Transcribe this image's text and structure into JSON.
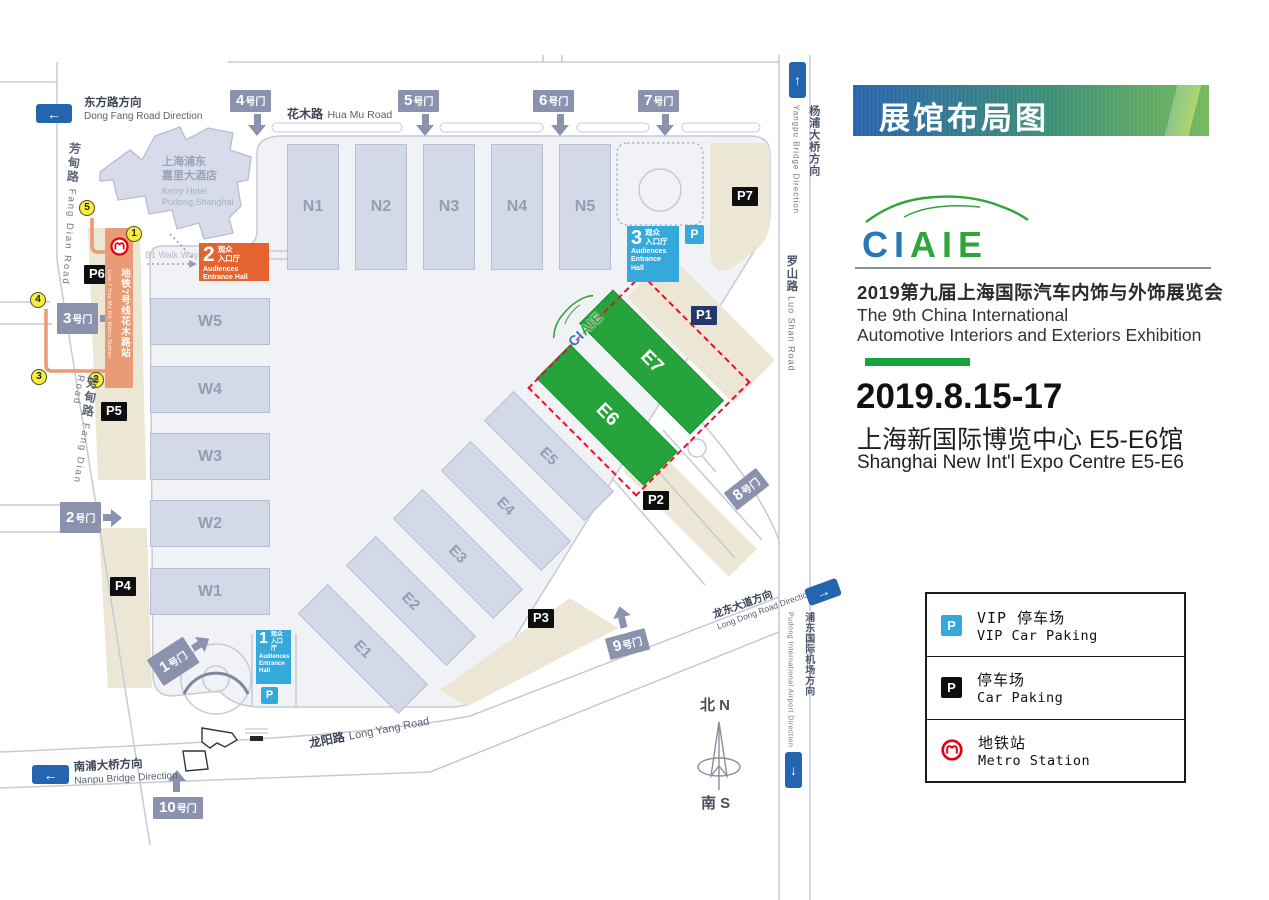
{
  "map": {
    "roads": {
      "dongfang": {
        "cn": "东方路方向",
        "en": "Dong Fang Road Direction"
      },
      "huamu": {
        "cn": "花木路",
        "en": "Hua Mu Road"
      },
      "fangdian": {
        "cn": "芳甸路",
        "en": "Fang Dian Road"
      },
      "yangpu": {
        "cn": "杨浦大桥方向",
        "en": "Yangpu Bridge Direction"
      },
      "luoshan": {
        "cn": "罗山路",
        "en": "Luo Shan Road"
      },
      "longyang": {
        "cn": "龙阳路",
        "en": "Long Yang Road"
      },
      "nanpu": {
        "cn": "南浦大桥方向",
        "en": "Nanpu Bridge Direction"
      },
      "longdong": {
        "cn": "龙东大道方向",
        "en": "Long Dong Road Direction"
      },
      "airport": {
        "cn": "浦东国际机场方向",
        "en": "Pudong International Airport Direction"
      }
    },
    "hotel": {
      "cn1": "上海浦东",
      "cn2": "嘉里大酒店",
      "en1": "Kerry Hotel",
      "en2": "Pudong,Shanghai"
    },
    "walkway": "B1 Walk Way",
    "metro_line": {
      "cn": "地铁7号线花木路站",
      "en": "Line 7 Hua Mu Rd. Metro Station"
    },
    "halls": {
      "n": [
        "N1",
        "N2",
        "N3",
        "N4",
        "N5"
      ],
      "w": [
        "W5",
        "W4",
        "W3",
        "W2",
        "W1"
      ],
      "e": [
        "E1",
        "E2",
        "E3",
        "E4",
        "E5"
      ],
      "green": [
        "E6",
        "E7"
      ]
    },
    "parkings": [
      "P1",
      "P2",
      "P3",
      "P4",
      "P5",
      "P6",
      "P7"
    ],
    "gates": [
      "1",
      "2",
      "3",
      "4",
      "5",
      "6",
      "7",
      "8",
      "9",
      "10"
    ],
    "gate_suffix": "号门",
    "ent": {
      "cn1": "观众",
      "cn2": "入口厅",
      "en": "Audiences Entrance Hall"
    },
    "entrances": {
      "one": "1",
      "two": "2",
      "three": "3"
    },
    "circled": [
      "1",
      "2",
      "3",
      "4",
      "5"
    ],
    "p_letter": "P",
    "compass": {
      "north": "北 N",
      "south": "南 S"
    }
  },
  "panel": {
    "banner": "展馆布局图",
    "logo_ci": "CI",
    "logo_aie": "AIE",
    "title_cn": "2019第九届上海国际汽车内饰与外饰展览会",
    "title_en1": "The 9th China International",
    "title_en2": "Automotive Interiors and Exteriors Exhibition",
    "date": "2019.8.15-17",
    "venue_cn": "上海新国际博览中心 E5-E6馆",
    "venue_en": "Shanghai New Int'l Expo Centre E5-E6"
  },
  "legend": {
    "items": [
      {
        "cn": "VIP 停车场",
        "en": "VIP Car Paking"
      },
      {
        "cn": "停车场",
        "en": "Car Paking"
      },
      {
        "cn": "地铁站",
        "en": "Metro Station"
      }
    ]
  }
}
